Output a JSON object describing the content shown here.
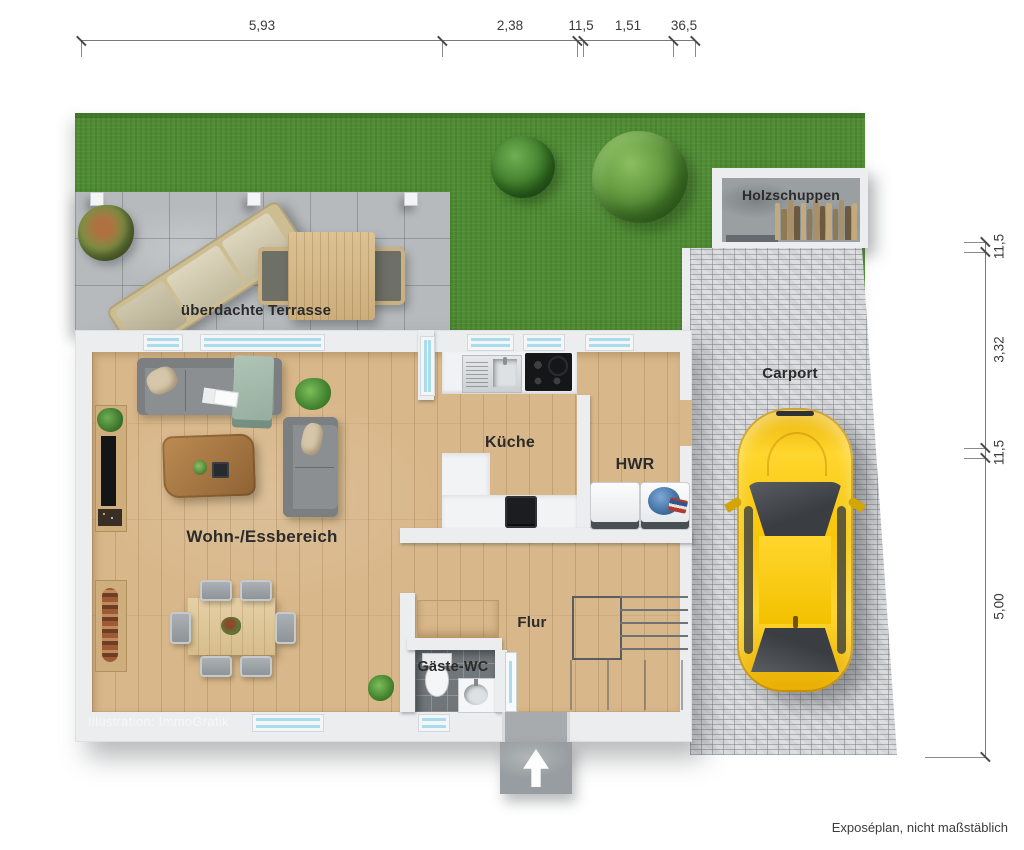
{
  "footer_note": "Exposéplan, nicht maßstäblich",
  "watermark": "Illustration: ImmoGrafik",
  "rooms": {
    "terrasse": {
      "label": "überdachte Terrasse"
    },
    "holzschuppen": {
      "label": "Holzschuppen"
    },
    "carport": {
      "label": "Carport"
    },
    "kueche": {
      "label": "Küche"
    },
    "hwr": {
      "label": "HWR"
    },
    "wohn_essbereich": {
      "label": "Wohn-/Essbereich"
    },
    "flur": {
      "label": "Flur"
    },
    "gaeste_wc": {
      "label": "Gäste-WC"
    }
  },
  "dimensions": {
    "top": {
      "d1": "5,93",
      "d2": "2,38",
      "d3": "11,5",
      "d4": "1,51",
      "d5": "36,5"
    },
    "right": {
      "r1": "11,5",
      "r2": "3,32",
      "r3": "11,5",
      "r4": "5,00"
    }
  },
  "colors": {
    "grass": "#4f8c33",
    "wood_floor": "#d8b78a",
    "terrace_tile": "#b6babd",
    "paving": "#d3d5d7",
    "wall": "#ebedee",
    "glass": "#a9dcec",
    "car_yellow": "#f8c500"
  }
}
